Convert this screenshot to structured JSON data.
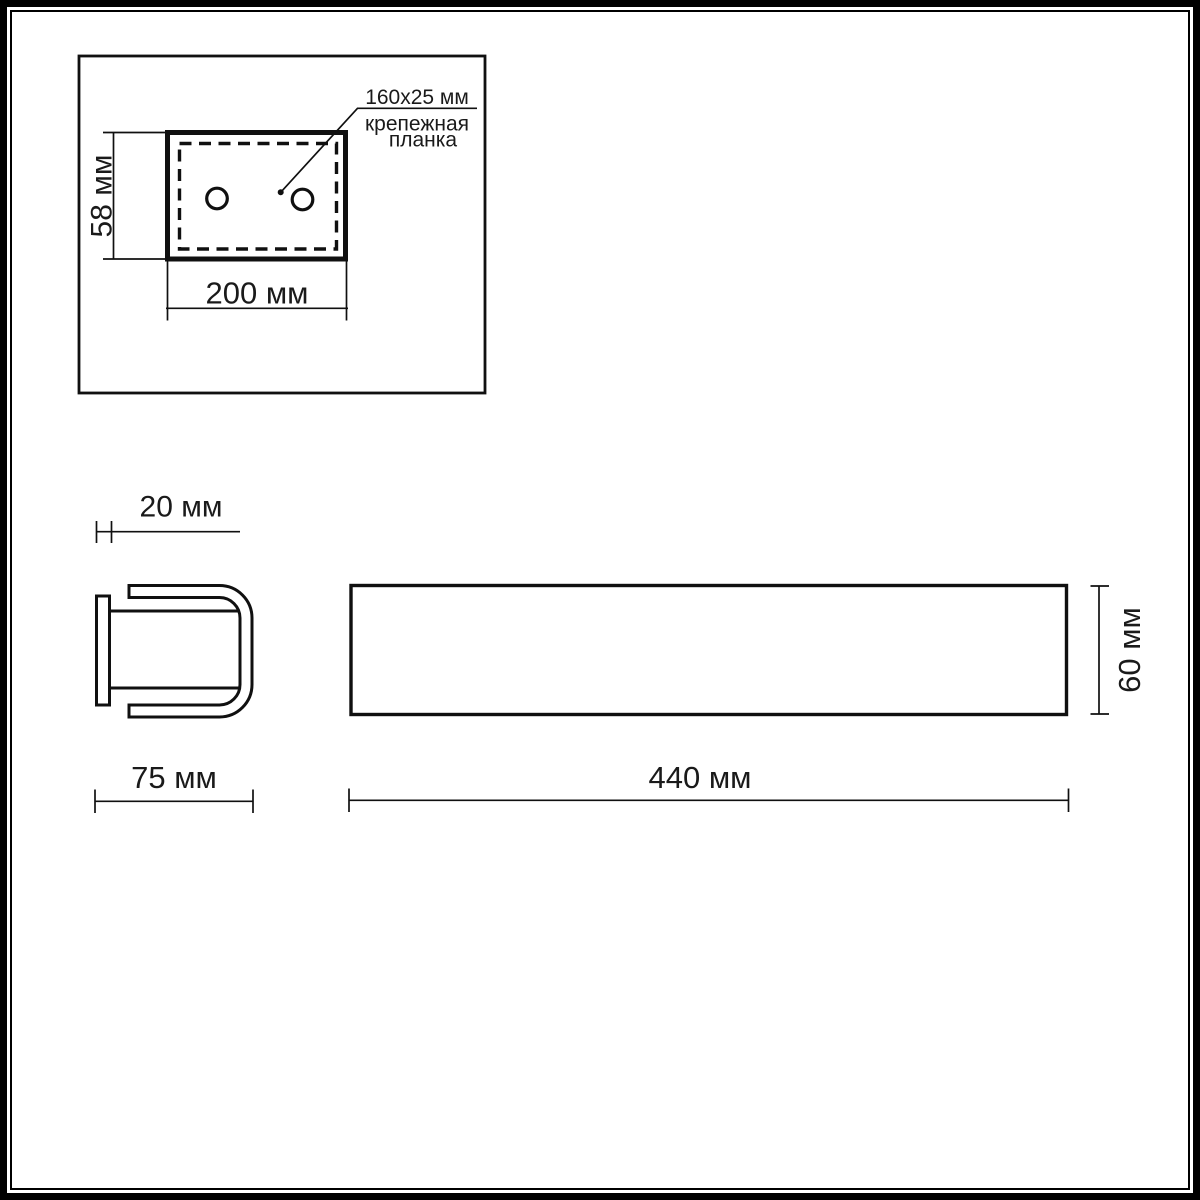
{
  "colors": {
    "line": "#101010",
    "text": "#1a1a1a",
    "background": "#ffffff"
  },
  "views": {
    "top": {
      "height_label": "58 мм",
      "width_label": "200 мм",
      "annotation": {
        "size": "160x25 мм",
        "name_line1": "крепежная",
        "name_line2": "планка"
      }
    },
    "side": {
      "depth_label": "20 мм",
      "width_label": "75 мм"
    },
    "front": {
      "width_label": "440 мм",
      "height_label": "60 мм"
    }
  }
}
